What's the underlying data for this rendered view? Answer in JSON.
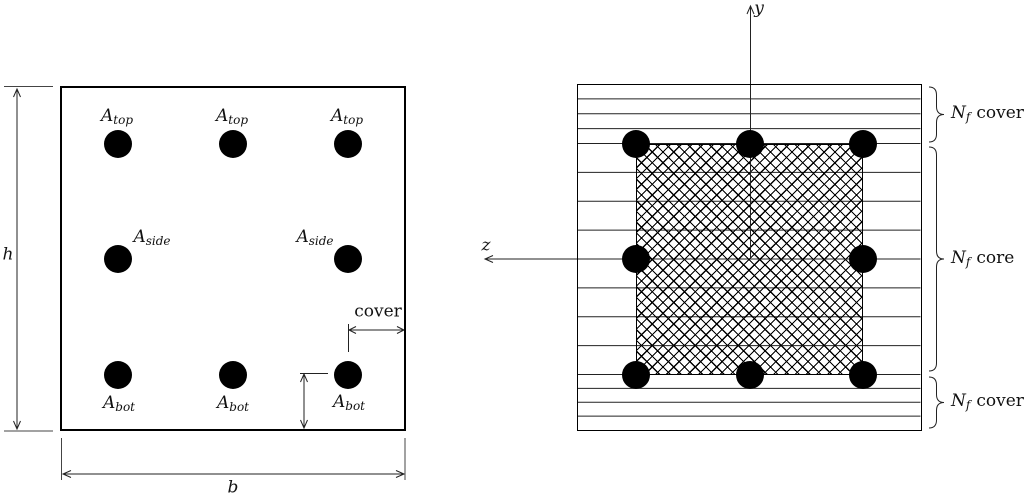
{
  "colors": {
    "ink": "#111111",
    "paper": "#ffffff"
  },
  "left_section": {
    "height_dim": "h",
    "width_dim": "b",
    "cover_dim": "cover",
    "rebar_top": {
      "sym": "A",
      "sub": "top"
    },
    "rebar_side": {
      "sym": "A",
      "sub": "side"
    },
    "rebar_bot": {
      "sym": "A",
      "sub": "bot"
    }
  },
  "right_section": {
    "axis_vertical": "y",
    "axis_horizontal": "z",
    "cover_top": {
      "sym": "N",
      "sub": "f",
      "word": "cover"
    },
    "core": {
      "sym": "N",
      "sub": "f",
      "word": "core"
    },
    "cover_bottom": {
      "sym": "N",
      "sub": "f",
      "word": "cover"
    },
    "layers": {
      "cover_top": 4,
      "core": 8,
      "cover_bottom": 4
    }
  }
}
